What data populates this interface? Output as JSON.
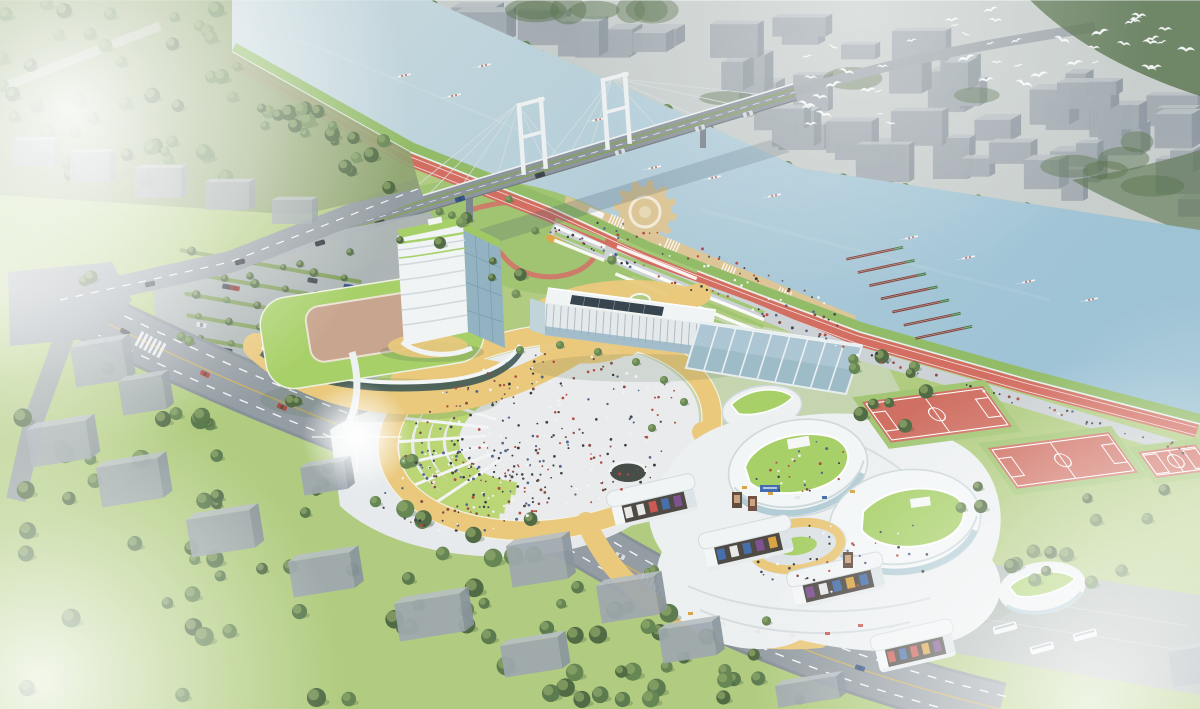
{
  "image": {
    "kind": "architectural aerial rendering",
    "width": 1200,
    "height": 709
  },
  "scene": {
    "setting": "riverside sports-and-culture campus seen from the air on a hazy morning",
    "objects": [
      "river",
      "cable-stayed bridge",
      "far-shore city blocks",
      "flock of white birds",
      "rowing crews on water",
      "moored rowing shells",
      "riverside red running track",
      "wooden waterfront deck",
      "gear-shaped pier",
      "striped lawn terraces",
      "office tower with green roof",
      "gymnasium with rooftop court",
      "white slab hall with louvers",
      "glass atrium hall",
      "curved mall complex with green roofs",
      "circular courtyard",
      "central sunken plaza with lawn terraces",
      "amber elevated walkway ring",
      "gate pavilions with storefronts",
      "red soccer fields",
      "small sports court",
      "tree-lined parking lot",
      "crossroads intersection",
      "main boulevard with buses",
      "residential blocks in trees",
      "coach parking lot",
      "morning fog",
      "sun glare"
    ],
    "counts": {
      "city_blocks": 58,
      "city_tree_patches": 16,
      "birds": 46,
      "rowing_crews": 12,
      "moored_shells": 7,
      "plaza_people": 260,
      "southwest_plaza_people": 110,
      "promenade_people": 85,
      "deck_people": 50,
      "complex_terrace_people": 70,
      "parking_tree_rows": 7,
      "residential_blocks": 14,
      "bottom_left_trees": 85,
      "top_left_trees": 65,
      "riverbank_trees": 42,
      "road_side_trees": 26,
      "field_side_trees": 16
    }
  },
  "colors": {
    "water_left": "#c9d9de",
    "water_right": "#9ac1d4",
    "far_city_base": "#c4cbc9",
    "block_front": "#9ba5ab",
    "block_side": "#86919a",
    "block_top": "#b5bdc1",
    "tree": "#5f814c",
    "tree_dark": "#49653c",
    "tree_light": "#8aa562",
    "grass": "#aecb7b",
    "lawn_bright": "#b9d56f",
    "park_green": "#9ec26d",
    "track_red": "#d2685c",
    "court_red": "#cf6a5c",
    "deck_tan": "#dcc493",
    "amber_path": "#eac878",
    "plaza_white": "#e9ebec",
    "pave_gray": "#cbd1d4",
    "road_gray": "#9099a0",
    "curb": "#848d94",
    "asphalt": "#aab2b6",
    "building_white": "#f2f5f6",
    "building_shade": "#cfd9dd",
    "glass_blue": "#8fb0c0",
    "atrium_glass": "#a9c6d2",
    "roof_green": "#a5cf63",
    "roof_court_tan": "#c7a289",
    "bridge_deck": "#8a9299",
    "pylon_white": "#eef1f2",
    "shell_red": "#7d3c35",
    "people_dark": "#3a3f45",
    "fog": "#ffffff",
    "shadow": "#3c5064",
    "sign_blue": "#3a66b0"
  }
}
